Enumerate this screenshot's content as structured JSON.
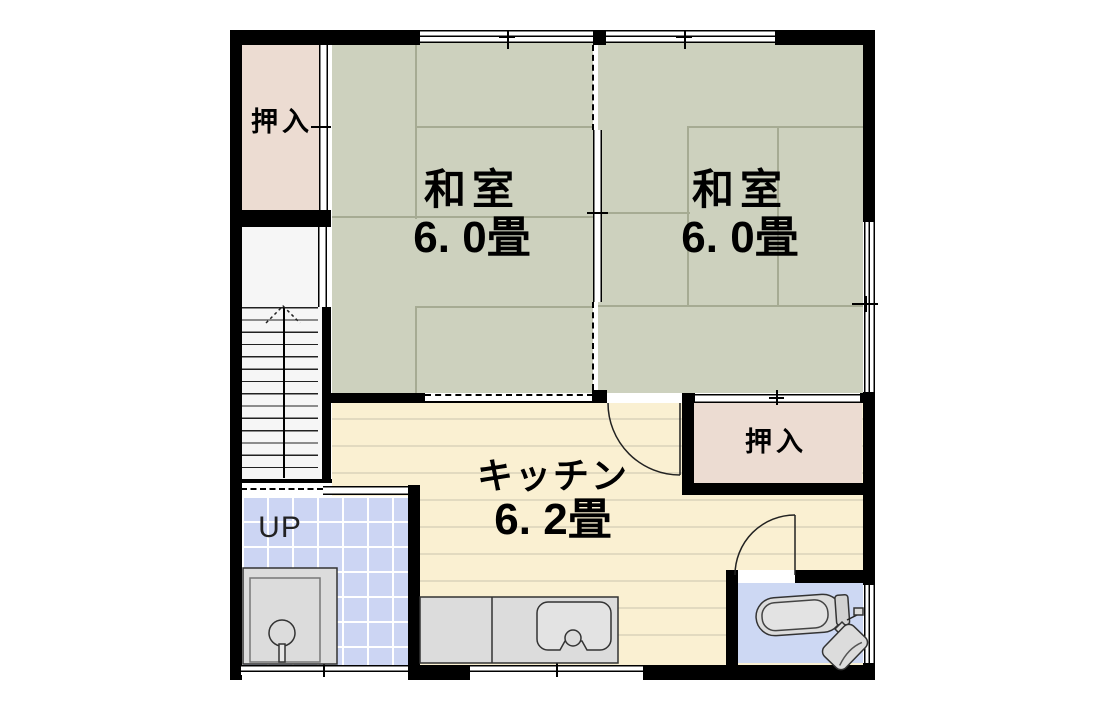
{
  "floor_plan": {
    "rooms": {
      "washitsu_left": {
        "name": "和室",
        "area": "6. 0畳"
      },
      "washitsu_right": {
        "name": "和室",
        "area": "6. 0畳"
      },
      "kitchen": {
        "name": "キッチン",
        "area": "6. 2畳"
      }
    },
    "closets": {
      "top_left": "押入",
      "bottom_right": "押入"
    },
    "stairs_label": "UP",
    "colors": {
      "tatami": "#cdd1be",
      "closet": "#ecdcd2",
      "kitchen_floor": "#faf0d2",
      "tile_floor": "#ccd5f3",
      "bath_floor": "#cdd8f3",
      "wall": "#000000",
      "fixture_gray": "#dcdcdc"
    }
  }
}
